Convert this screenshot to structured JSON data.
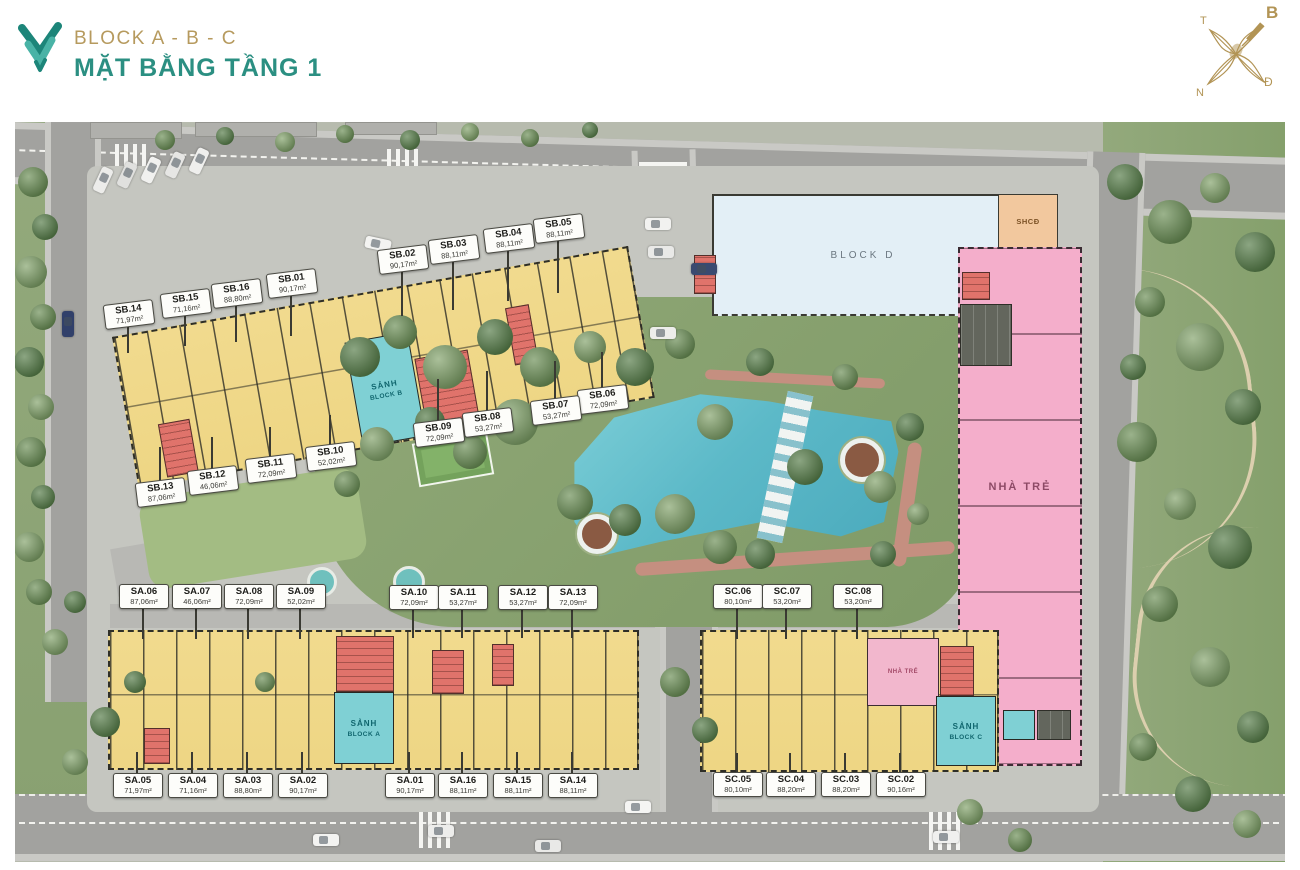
{
  "header": {
    "brand": "BLOCK A - B - C",
    "title": "MẶT BẰNG TẦNG 1"
  },
  "compass": {
    "north": "B",
    "west": "T",
    "east": "Đ",
    "south": "N"
  },
  "site": {
    "block_d_label": "BLOCK D",
    "shcd_label": "SHCĐ",
    "nursery_label": "NHÀ TRẺ",
    "nursery_room_label": "NHÀ TRẺ",
    "lobby_b": {
      "line1": "SẢNH",
      "line2": "BLOCK B"
    },
    "lobby_a": {
      "line1": "SẢNH",
      "line2": "BLOCK A"
    },
    "lobby_c": {
      "line1": "SẢNH",
      "line2": "BLOCK C"
    }
  },
  "palette": {
    "apartment_yellow": "#f1da8e",
    "lobby_teal": "#7fd0d4",
    "core_red": "#e0736b",
    "nursery_pink": "#f4aecb",
    "block_d_blue": "#e3eff6",
    "shcd_tan": "#f2c89e",
    "pool_blue": "#5cb9c8",
    "title_teal": "#2b8f82",
    "title_gold": "#b69a5e"
  },
  "units": [
    {
      "id": "SB.01",
      "area": "90,17m²",
      "block": "B"
    },
    {
      "id": "SB.02",
      "area": "90,17m²",
      "block": "B"
    },
    {
      "id": "SB.03",
      "area": "88,11m²",
      "block": "B"
    },
    {
      "id": "SB.04",
      "area": "88,11m²",
      "block": "B"
    },
    {
      "id": "SB.05",
      "area": "88,11m²",
      "block": "B"
    },
    {
      "id": "SB.06",
      "area": "72,09m²",
      "block": "B"
    },
    {
      "id": "SB.07",
      "area": "53,27m²",
      "block": "B"
    },
    {
      "id": "SB.08",
      "area": "53,27m²",
      "block": "B"
    },
    {
      "id": "SB.09",
      "area": "72,09m²",
      "block": "B"
    },
    {
      "id": "SB.10",
      "area": "52,02m²",
      "block": "B"
    },
    {
      "id": "SB.11",
      "area": "72,09m²",
      "block": "B"
    },
    {
      "id": "SB.12",
      "area": "46,06m²",
      "block": "B"
    },
    {
      "id": "SB.13",
      "area": "87,06m²",
      "block": "B"
    },
    {
      "id": "SB.14",
      "area": "71,97m²",
      "block": "B"
    },
    {
      "id": "SB.15",
      "area": "71,16m²",
      "block": "B"
    },
    {
      "id": "SB.16",
      "area": "88,80m²",
      "block": "B"
    },
    {
      "id": "SA.01",
      "area": "90,17m²",
      "block": "A"
    },
    {
      "id": "SA.02",
      "area": "90,17m²",
      "block": "A"
    },
    {
      "id": "SA.03",
      "area": "88,80m²",
      "block": "A"
    },
    {
      "id": "SA.04",
      "area": "71,16m²",
      "block": "A"
    },
    {
      "id": "SA.05",
      "area": "71,97m²",
      "block": "A"
    },
    {
      "id": "SA.06",
      "area": "87,06m²",
      "block": "A"
    },
    {
      "id": "SA.07",
      "area": "46,06m²",
      "block": "A"
    },
    {
      "id": "SA.08",
      "area": "72,09m²",
      "block": "A"
    },
    {
      "id": "SA.09",
      "area": "52,02m²",
      "block": "A"
    },
    {
      "id": "SA.10",
      "area": "72,09m²",
      "block": "A"
    },
    {
      "id": "SA.11",
      "area": "53,27m²",
      "block": "A"
    },
    {
      "id": "SA.12",
      "area": "53,27m²",
      "block": "A"
    },
    {
      "id": "SA.13",
      "area": "72,09m²",
      "block": "A"
    },
    {
      "id": "SA.14",
      "area": "88,11m²",
      "block": "A"
    },
    {
      "id": "SA.15",
      "area": "88,11m²",
      "block": "A"
    },
    {
      "id": "SA.16",
      "area": "88,11m²",
      "block": "A"
    },
    {
      "id": "SC.02",
      "area": "90,16m²",
      "block": "C"
    },
    {
      "id": "SC.03",
      "area": "88,20m²",
      "block": "C"
    },
    {
      "id": "SC.04",
      "area": "88,20m²",
      "block": "C"
    },
    {
      "id": "SC.05",
      "area": "80,10m²",
      "block": "C"
    },
    {
      "id": "SC.06",
      "area": "80,10m²",
      "block": "C"
    },
    {
      "id": "SC.07",
      "area": "53,20m²",
      "block": "C"
    },
    {
      "id": "SC.08",
      "area": "53,20m²",
      "block": "C"
    }
  ]
}
